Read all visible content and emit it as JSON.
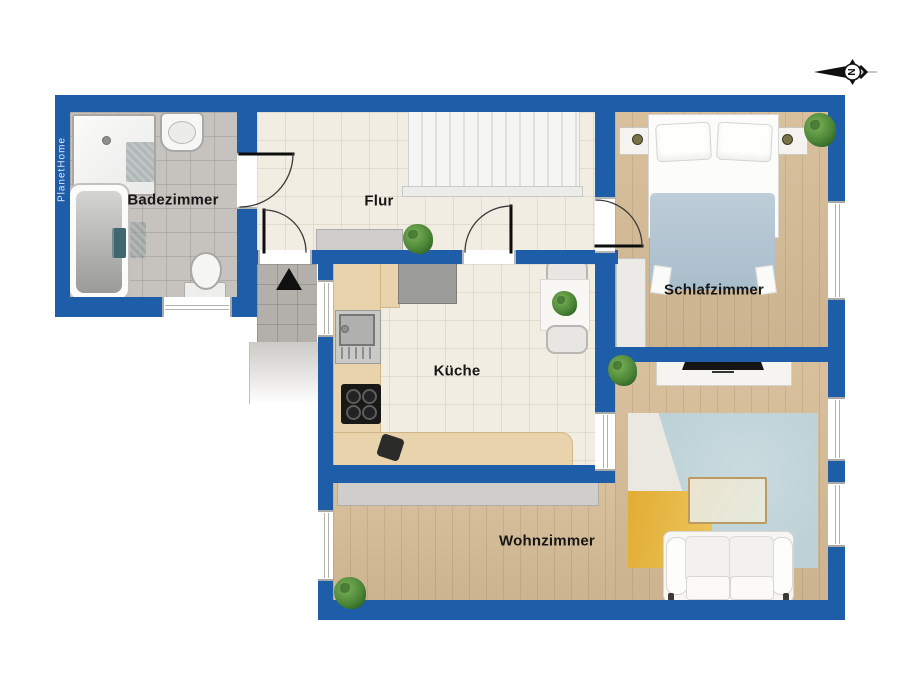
{
  "brand": "PlanetHome",
  "compass": {
    "letter": "N"
  },
  "rooms": [
    {
      "id": "badezimmer",
      "label": "Badezimmer"
    },
    {
      "id": "flur",
      "label": "Flur"
    },
    {
      "id": "schlafzimmer",
      "label": "Schlafzimmer"
    },
    {
      "id": "kueche",
      "label": "Küche"
    },
    {
      "id": "wohnzimmer",
      "label": "Wohnzimmer"
    }
  ],
  "colors": {
    "wall": "#1e5da7",
    "wood_floor": "#d7bd98",
    "tile_floor": "#f2ede2",
    "bath_floor": "#c6c3bf",
    "stairs": "#f5f5f3",
    "rug_teal": "#bdd2d7",
    "rug_yellow": "#e4b23e",
    "plant_green": "#4c8637",
    "label_text": "#161616"
  },
  "fixtures": {
    "badezimmer": [
      "shower",
      "washbasin",
      "bathtub",
      "toilet",
      "bath-mat",
      "bath-mat"
    ],
    "flur": [
      "staircase",
      "sideboard",
      "plant",
      "entrance-arrow"
    ],
    "schlafzimmer": [
      "double-bed",
      "nightstand",
      "nightstand",
      "wardrobe",
      "plant"
    ],
    "kueche": [
      "kitchen-counter",
      "refrigerator",
      "sink",
      "cooktop",
      "waste-bin",
      "dining-table",
      "chair",
      "chair",
      "plant"
    ],
    "wohnzimmer": [
      "tv-sideboard",
      "tv",
      "sideboard",
      "rug",
      "coffee-table",
      "sofa",
      "plant",
      "plant"
    ]
  }
}
